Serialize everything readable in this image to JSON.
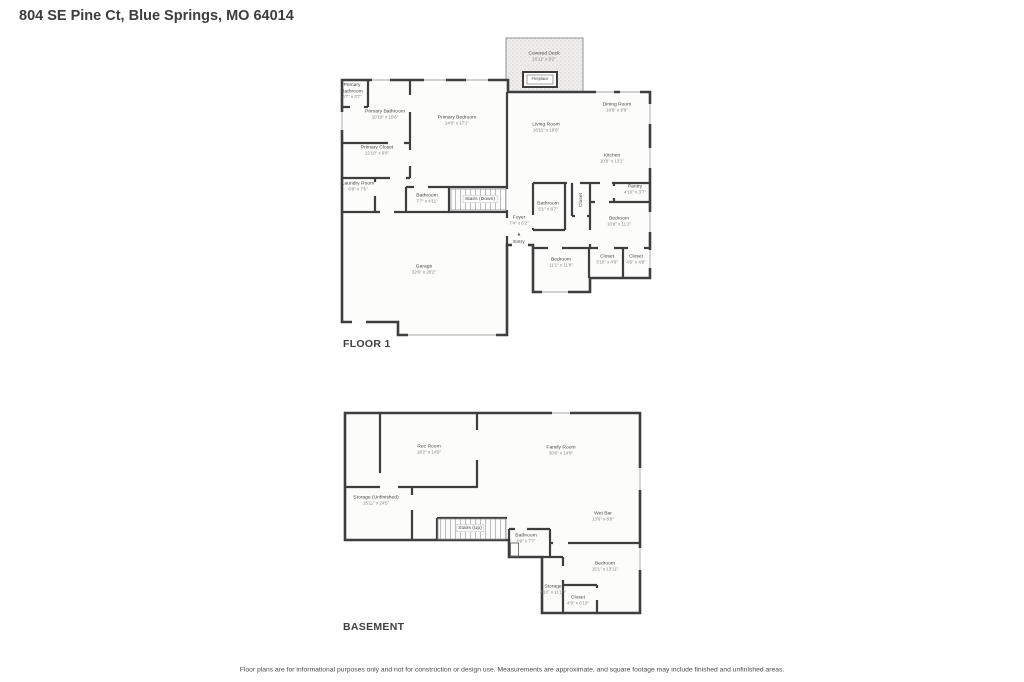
{
  "title": "804 SE Pine Ct, Blue Springs, MO 64014",
  "colors": {
    "walls": "#3e3e3e",
    "room_text": "#454545",
    "dims_text": "#808080"
  },
  "floor1": {
    "label": "FLOOR 1",
    "rooms": {
      "covered_deck": {
        "name": "Covered Deck",
        "dims": "16'11\" x 9'2\""
      },
      "fireplace": {
        "name": "Fireplace"
      },
      "primary_bathroom_small": {
        "name": "Primary Bathroom",
        "dims": "4'7\" x 3'7\""
      },
      "primary_bathroom": {
        "name": "Primary Bathroom",
        "dims": "10'10\" x 10'6\""
      },
      "primary_closet": {
        "name": "Primary Closet",
        "dims": "12'10\" x 6'8\""
      },
      "primary_bedroom": {
        "name": "Primary Bedroom",
        "dims": "14'6\" x 17'1\""
      },
      "living_room": {
        "name": "Living Room",
        "dims": "16'11\" x 19'6\""
      },
      "dining_room": {
        "name": "Dining Room",
        "dims": "10'8\" x 9'9\""
      },
      "kitchen": {
        "name": "Kitchen",
        "dims": "10'8\" x 13'1\""
      },
      "pantry": {
        "name": "Pantry",
        "dims": "4'10\" x 3'7\""
      },
      "laundry_room": {
        "name": "Laundry Room",
        "dims": "6'8\" x 7'6\""
      },
      "hall_bathroom": {
        "name": "Bathroom",
        "dims": "7'7\" x 4'11\""
      },
      "stairs_down": {
        "name": "Stairs (Down)"
      },
      "foyer": {
        "name": "Foyer",
        "dims": "7'4\" x 6'2\""
      },
      "entry": {
        "name": "Entry",
        "icon": "▲"
      },
      "bathroom_2": {
        "name": "Bathroom",
        "dims": "5'1\" x 8'7\""
      },
      "closet_hall": {
        "name": "Closet"
      },
      "bedroom_1": {
        "name": "Bedroom",
        "dims": "10'8\" x 11'1\""
      },
      "bedroom_2": {
        "name": "Bedroom",
        "dims": "11'1\" x 11'8\""
      },
      "closet_1": {
        "name": "Closet",
        "dims": "3'10\" x 4'8\""
      },
      "closet_2": {
        "name": "Closet",
        "dims": "4'6\" x 4'8\""
      },
      "garage": {
        "name": "Garage",
        "dims": "32'6\" x 20'2\""
      }
    }
  },
  "basement": {
    "label": "BASEMENT",
    "rooms": {
      "rec_room": {
        "name": "Rec Room",
        "dims": "18'2\" x 14'9\""
      },
      "family_room": {
        "name": "Family Room",
        "dims": "30'6\" x 14'9\""
      },
      "storage_unfinished": {
        "name": "Storage (Unfinished)",
        "dims": "15'11\" x 24'5\""
      },
      "stairs_up": {
        "name": "Stairs (Up)"
      },
      "bathroom": {
        "name": "Bathroom",
        "dims": "4'9\" x 7'7\""
      },
      "wet_bar": {
        "name": "Wet Bar",
        "dims": "13'6\" x 8'9\""
      },
      "bedroom": {
        "name": "Bedroom",
        "dims": "15'1\" x 13'11\""
      },
      "storage": {
        "name": "Storage",
        "dims": "4'10\" x 11'10\""
      },
      "closet": {
        "name": "Closet",
        "dims": "4'9\" x 6'10\""
      }
    }
  },
  "footer": {
    "disclaimer": "Floor plans are for informational purposes only and not for construction or design use. Measurements are approximate, and square footage may include finished and unfinished areas."
  }
}
